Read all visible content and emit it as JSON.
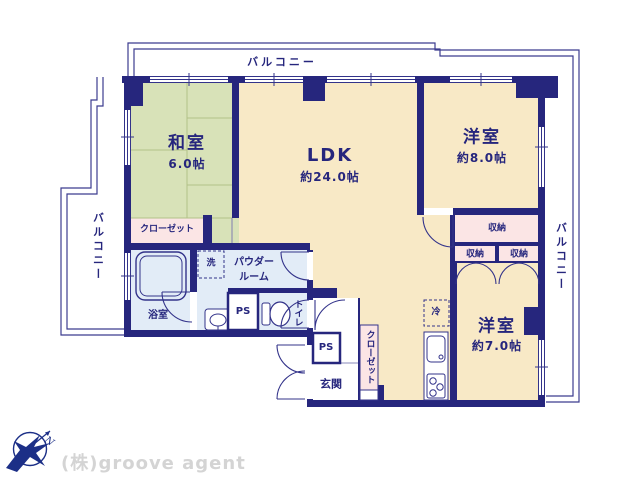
{
  "company": {
    "watermark": "(株)groove agent",
    "compass_letter": "N"
  },
  "balconies": {
    "top": "バルコニー",
    "left": "バルコニー",
    "right": "バルコニー"
  },
  "rooms": {
    "washitsu": {
      "name": "和室",
      "size": "6.0帖"
    },
    "ldk": {
      "name": "LDK",
      "size": "約24.0帖"
    },
    "bedroom8": {
      "name": "洋室",
      "size": "約8.0帖"
    },
    "bedroom7": {
      "name": "洋室",
      "size": "約7.0帖"
    },
    "bath": "浴室",
    "powder_line1": "パウダー",
    "powder_line2": "ルーム",
    "toilet": "トイレ",
    "genkan": "玄関",
    "closet_washitsu": "クローゼット",
    "closet_hall": "クローゼット",
    "storage_wide": "収納",
    "storage_a": "収納",
    "storage_b": "収納",
    "ps_west": "PS",
    "ps_hall": "PS",
    "laundry": "洗",
    "fridge": "冷"
  },
  "colors": {
    "wall": "#26267d",
    "tatami": "#d8e2b8",
    "flooring": "#f8e9c6",
    "storage_pink": "#fbe5e5",
    "wet_blue": "#e2ecf7",
    "line": "#33338a",
    "watermark_gray": "#d4d4d4"
  }
}
